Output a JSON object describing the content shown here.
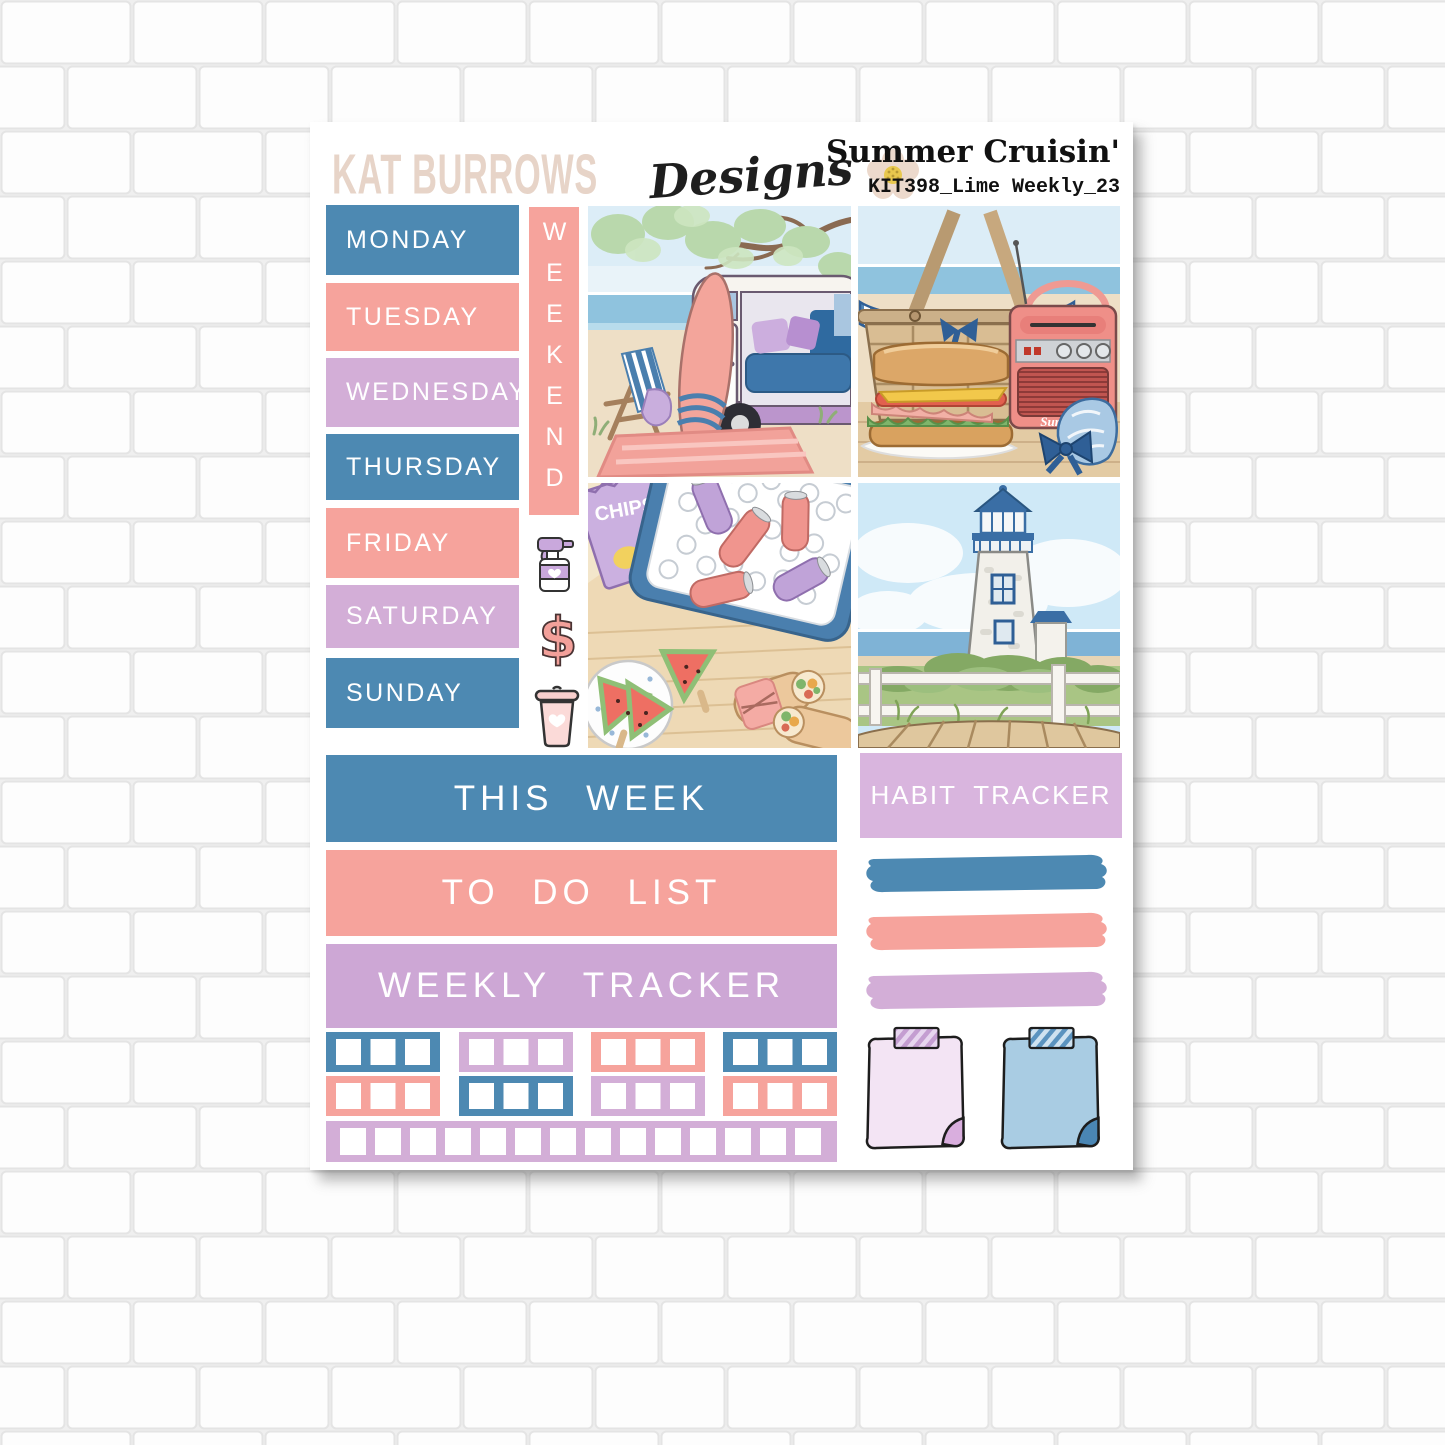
{
  "header": {
    "brand_name": "KAT BURROWS",
    "brand_script": "Designs",
    "kit_title": "Summer Cruisin'",
    "kit_code": "KIT398_Lime Weekly_23"
  },
  "days": [
    {
      "label": "MONDAY",
      "color": "blue"
    },
    {
      "label": "TUESDAY",
      "color": "salmon"
    },
    {
      "label": "WEDNESDAY",
      "color": "lavender"
    },
    {
      "label": "THURSDAY",
      "color": "blue"
    },
    {
      "label": "FRIDAY",
      "color": "salmon"
    },
    {
      "label": "SATURDAY",
      "color": "lavender"
    },
    {
      "label": "SUNDAY",
      "color": "blue"
    }
  ],
  "weekend_label": "WEEKEND",
  "icons": [
    {
      "name": "spray-bottle-icon"
    },
    {
      "name": "dollar-sign-icon",
      "glyph": "$"
    },
    {
      "name": "trash-can-icon"
    }
  ],
  "banners": {
    "this_week": "THIS WEEK",
    "to_do_list": "TO DO LIST",
    "weekly_tracker": "WEEKLY TRACKER",
    "habit_tracker": "HABIT TRACKER"
  },
  "images": [
    {
      "name": "beach-camper",
      "description": "Camper van on the beach with surfboard, striped chair and pink rug"
    },
    {
      "name": "picnic-basket",
      "description": "Wicker picnic basket, sandwich and retro radio",
      "radio_label": "Summer"
    },
    {
      "name": "drinks-cooler",
      "description": "Cooler of iced cans with watermelon, wraps and chips",
      "chips_label": "CHIPS"
    },
    {
      "name": "lighthouse",
      "description": "Lighthouse behind white fence and boardwalk"
    }
  ],
  "swatches": [
    {
      "name": "blue-brush-stroke",
      "color": "#4d89b2"
    },
    {
      "name": "salmon-brush-stroke",
      "color": "#f6a39c"
    },
    {
      "name": "lavender-brush-stroke",
      "color": "#d3aed7"
    }
  ],
  "checkbox_rows": {
    "row1": [
      "blue",
      "lavender",
      "salmon",
      "blue"
    ],
    "row2": [
      "salmon",
      "blue",
      "lavender",
      "salmon"
    ],
    "strip": {
      "color": "lavender",
      "squares": 14
    }
  },
  "sticky_notes": [
    {
      "name": "lavender-sticky-note",
      "color": "#f3e4f4"
    },
    {
      "name": "blue-sticky-note",
      "color": "#a9cce3"
    }
  ],
  "palette": {
    "blue": "#4d89b2",
    "salmon": "#f6a39c",
    "lavender": "#d3aed7",
    "lavender_light": "#d9b5de",
    "lavender_deep": "#cda7d5",
    "brand_beige": "#e7d4c8",
    "sticky_pink": "#f3e4f4",
    "sticky_blue": "#a9cce3",
    "paper": "#ffffff"
  }
}
